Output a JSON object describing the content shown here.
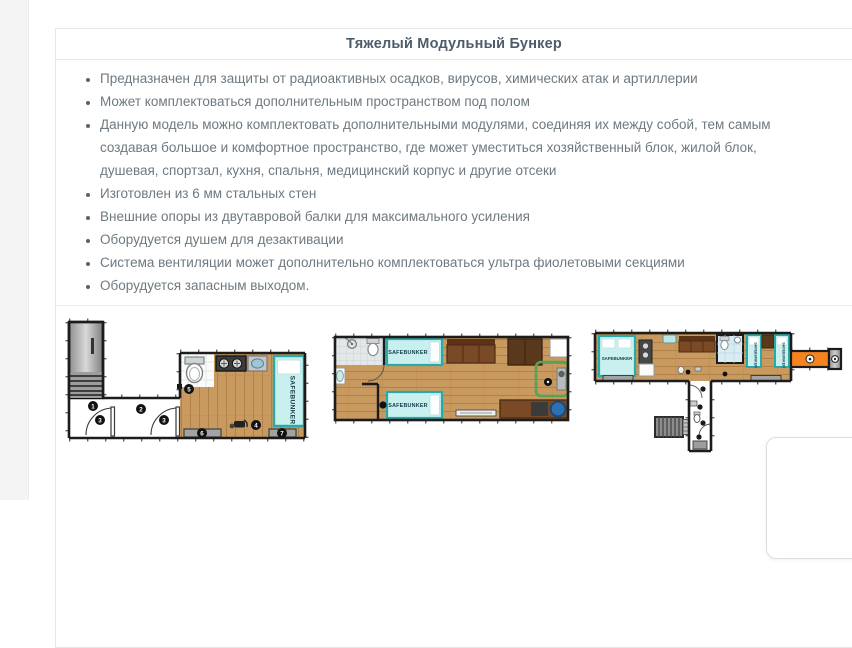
{
  "panel": {
    "title": "Тяжелый Модульный Бункер",
    "bullets": [
      "Предназначен для защиты от радиоактивных осадков, вирусов, химических атак и артиллерии",
      "Может комплектоваться дополнительным пространством под полом",
      "Данную модель можно комплектовать дополнительными модулями, соединяя их между собой, тем самым создавая большое и комфортное пространство, где может уместиться хозяйственный блок, жилой блок, душевая, спортзал, кухня, спальня, медицинский корпус и другие отсеки",
      "Изготовлен из 6 мм стальных стен",
      "Внешние опоры из двутавровой балки для максимального усиления",
      "Оборудуется душем для дезактивации",
      "Система вентиляции может дополнительно комплектоваться ультра фиолетовыми секциями",
      "Оборудуется запасным выходом."
    ]
  },
  "floorplans": {
    "brand": "SAFEBUNKER",
    "plan1": {
      "description": "entrance-staircase-corridor-and-main-room",
      "markers": [
        "1",
        "2",
        "3",
        "3",
        "4",
        "5",
        "6",
        "7"
      ]
    },
    "plan2": {
      "description": "living-module-with-two-beds-bathroom-gym-and-desk"
    },
    "plan3": {
      "description": "extended-module-with-beds-bathroom-orange-tunnel-and-exit-corridor"
    }
  },
  "colors": {
    "panel_border": "#e7e7e7",
    "title_text": "#4d5c6a",
    "body_text": "#6e7980",
    "wood_floor": "#c99a5f",
    "bed_teal": "#2aa9a9",
    "bed_fill": "#c9efef",
    "corridor_orange": "#f5831e",
    "zone_green": "#57a257",
    "stool_blue": "#2e6fb0"
  }
}
